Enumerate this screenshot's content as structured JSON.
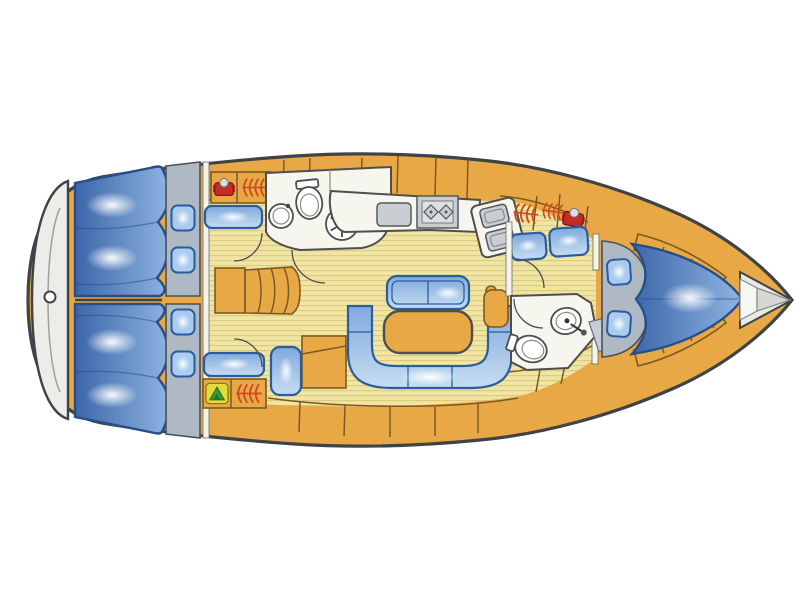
{
  "document": {
    "title": "Sailing yacht interior layout — top-view deck plan",
    "type": "boat-floor-plan",
    "bow_direction": "right",
    "stern_direction": "left",
    "background": "#FFFFFF"
  },
  "palette": {
    "hull_outline": "#3E4347",
    "deck_wood": "#E8A845",
    "wood_outline": "#7A5A22",
    "floor": "#F0E5A2",
    "floor_stripe": "#DBCA7F",
    "white_room": "#F7F6EE",
    "room_outline": "#4E4E4E",
    "transom": "#ECECE8",
    "gray_base": "#AEB9C4",
    "appliance_gray": "#C9CED3",
    "bed_dark": "#3B66A8",
    "bed_light": "#8FB4E2",
    "bed_outline": "#274E86",
    "cushion_dark": "#7FA9DC",
    "cushion_light": "#C6DDF2",
    "cushion_outline": "#2B5C9E",
    "pillow": "#A9CBEE",
    "accent_red": "#C32B26",
    "locker_arc_red": "#CC4A1E",
    "accent_yellow": "#E8D93A",
    "accent_green": "#3A9A3A"
  },
  "rooms": {
    "stern_platform": {
      "label": "Stern swim platform with rudder fitting"
    },
    "aft_cabin_port": {
      "label": "Aft double cabin (port) with berth, pillows, seat and hanging locker"
    },
    "aft_cabin_starboard": {
      "label": "Aft double cabin (starboard) with berth, pillows, seat and hanging locker"
    },
    "aft_head": {
      "label": "Aft head with toilet, washbasin and shower"
    },
    "galley": {
      "label": "Galley with refrigerator, two-burner stove and double sink"
    },
    "salon": {
      "label": "Salon with U-shaped settee, table and straight settee"
    },
    "nav_station": {
      "label": "Navigation station with chart table and seat"
    },
    "companionway": {
      "label": "Companionway steps"
    },
    "forward_head": {
      "label": "Forward head with toilet and washbasin"
    },
    "forward_cabin": {
      "label": "Forward V-berth cabin with pillows and side shelves"
    },
    "bow_locker": {
      "label": "Bow anchor locker"
    }
  },
  "fixtures": {
    "berth": "double berth mattress",
    "pillow": "pillow",
    "bench_seat": "upholstered seat",
    "u_settee": "U-shaped settee",
    "straight_settee": "two-seat settee",
    "salon_table": "salon table",
    "chart_table": "chart table",
    "stove": "two-burner stove",
    "double_sink": "double sink",
    "fridge": "refrigerator / icebox",
    "toilet": "marine toilet",
    "washbasin": "round washbasin",
    "shower_drain": "shower with spoked drain grate",
    "hanging_locker": "hanging locker (wardrobe arcs)",
    "steps": "companionway steps"
  },
  "icons": [
    "red-appliance-icon",
    "wardrobe-arcs-icon",
    "yellow-green-locker-icon",
    "shower-wheel-icon",
    "rudder-fitting-icon"
  ]
}
